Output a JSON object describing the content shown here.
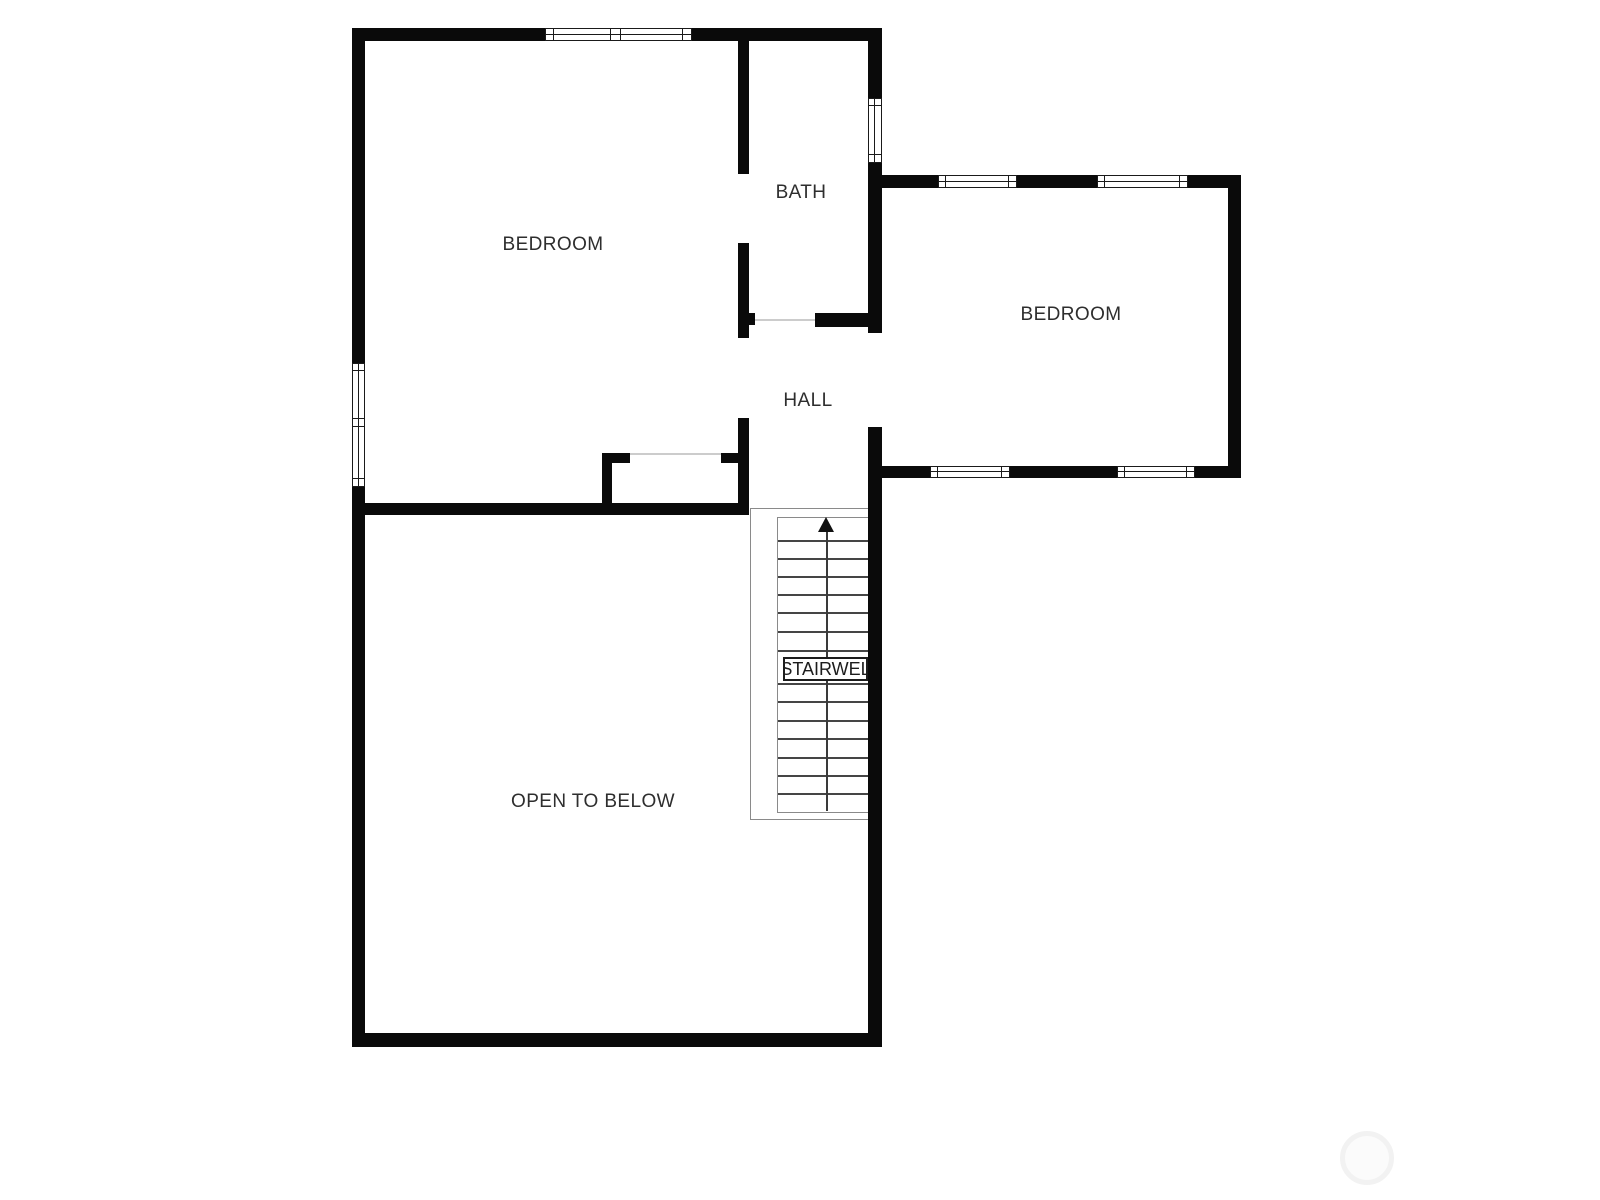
{
  "rooms": {
    "bedroom_left": "BEDROOM",
    "bath": "BATH",
    "bedroom_right": "BEDROOM",
    "hall": "HALL",
    "stairwell": "STAIRWEL",
    "open_to_below": "OPEN TO BELOW"
  },
  "stairs": {
    "direction": "up",
    "visible_tread_lines": 14
  },
  "colors": {
    "background": "#ffffff",
    "walls": "#0a0a0a",
    "room_labels": "#2e2e2e",
    "stair_tread_lines": "#454545",
    "stair_outline": "#8a8a8a",
    "door_threshold": "#cccccc",
    "watermark_circle": "#f2f2f2"
  }
}
